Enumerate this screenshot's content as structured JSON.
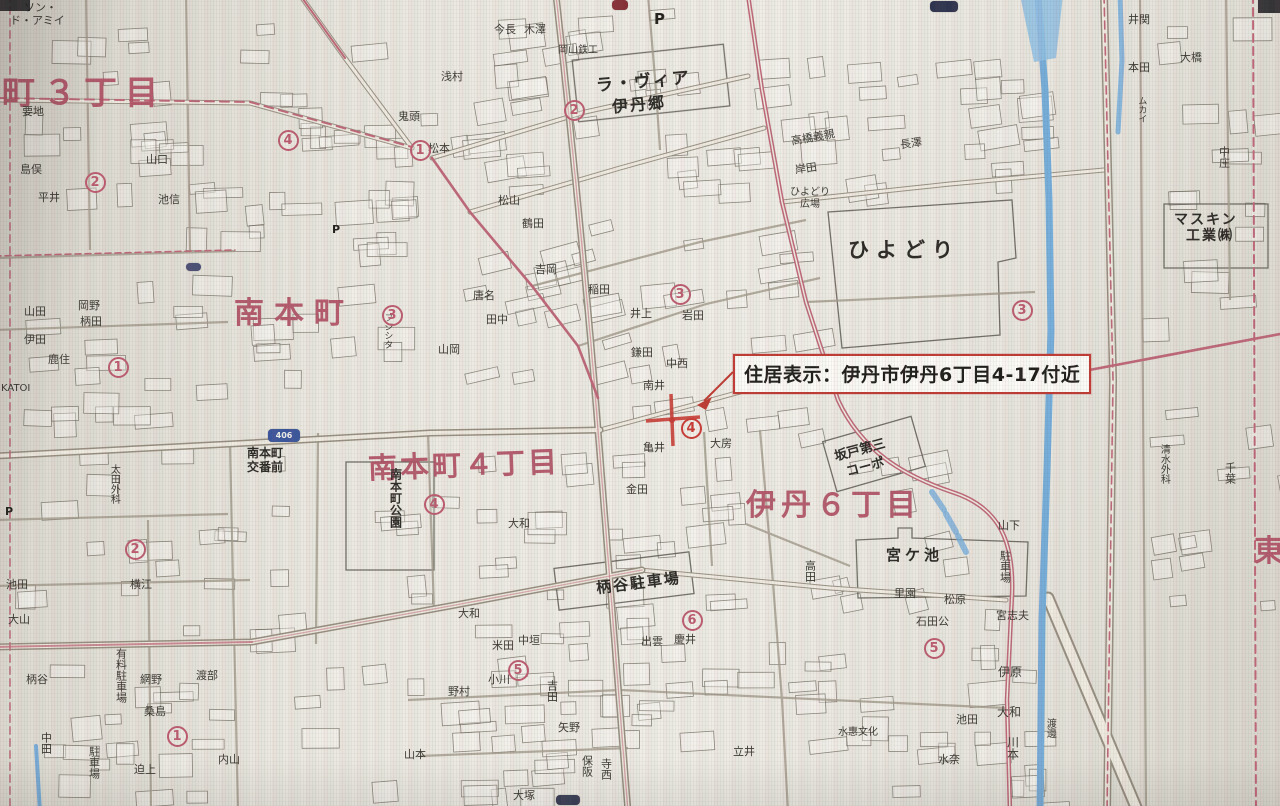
{
  "annotation": {
    "label": "住居表示：伊丹市伊丹6丁目4-17付近"
  },
  "colors": {
    "district_pink": "#b44f64",
    "annotation_red": "#c43a32",
    "river_blue": "#74aedd",
    "road_pink": "#c2677a",
    "paper": "#e9e6de"
  },
  "marker": {
    "x": 672,
    "y": 420
  },
  "map": {
    "labels": [
      {
        "t": "町３丁目",
        "x": 2,
        "y": 76,
        "s": 33,
        "c": "pink",
        "ls": 8
      },
      {
        "t": "南本町",
        "x": 234,
        "y": 298,
        "s": 30,
        "c": "pink",
        "ls": 10
      },
      {
        "t": "南本町４丁目",
        "x": 368,
        "y": 450,
        "s": 29,
        "c": "pink",
        "ls": 3,
        "r": -2
      },
      {
        "t": "伊丹６丁目",
        "x": 746,
        "y": 490,
        "s": 30,
        "c": "pink",
        "ls": 5
      },
      {
        "t": "東",
        "x": 1254,
        "y": 536,
        "s": 30,
        "c": "pink"
      },
      {
        "t": "ラ・ヴィア",
        "x": 596,
        "y": 74,
        "s": 17,
        "c": "place",
        "r": -5,
        "ls": 2
      },
      {
        "t": "伊丹郷",
        "x": 612,
        "y": 97,
        "s": 16,
        "c": "place",
        "r": -5,
        "ls": 2
      },
      {
        "t": "ひよどり",
        "x": 848,
        "y": 240,
        "s": 21,
        "c": "place",
        "ls": 7
      },
      {
        "t": "ひよどり",
        "x": 790,
        "y": 188,
        "s": 10
      },
      {
        "t": "広場",
        "x": 800,
        "y": 200,
        "s": 10
      },
      {
        "t": "宮ケ池",
        "x": 886,
        "y": 548,
        "s": 15,
        "c": "place",
        "ls": 4
      },
      {
        "t": "柄谷駐車場",
        "x": 596,
        "y": 576,
        "s": 15,
        "c": "place",
        "r": -7,
        "ls": 2
      },
      {
        "t": "坂戸第三",
        "x": 834,
        "y": 444,
        "s": 13,
        "c": "place",
        "r": -15
      },
      {
        "t": "コーポ",
        "x": 846,
        "y": 461,
        "s": 13,
        "c": "place",
        "r": -15
      },
      {
        "t": "南本町",
        "x": 247,
        "y": 447,
        "s": 12,
        "c": "place"
      },
      {
        "t": "交番前",
        "x": 247,
        "y": 461,
        "s": 12,
        "c": "place"
      },
      {
        "t": "南本町公園",
        "x": 389,
        "y": 468,
        "s": 12,
        "c": "place",
        "v": 1
      },
      {
        "t": "マスキン",
        "x": 1174,
        "y": 213,
        "s": 14,
        "c": "place",
        "ls": 2
      },
      {
        "t": "工業㈱",
        "x": 1186,
        "y": 229,
        "s": 14,
        "c": "place",
        "ls": 2
      },
      {
        "t": "有料駐車場",
        "x": 115,
        "y": 648,
        "s": 11,
        "v": 1
      },
      {
        "t": "駐車場",
        "x": 88,
        "y": 746,
        "s": 11,
        "v": 1
      },
      {
        "t": "駐車場",
        "x": 999,
        "y": 550,
        "s": 11,
        "v": 1
      },
      {
        "t": "山下",
        "x": 998,
        "y": 520,
        "s": 11
      },
      {
        "t": "高橋義親",
        "x": 791,
        "y": 132,
        "s": 11,
        "r": -10
      },
      {
        "t": "岸田",
        "x": 795,
        "y": 163,
        "s": 11,
        "r": -8
      },
      {
        "t": "長澤",
        "x": 900,
        "y": 138,
        "s": 11,
        "r": -8
      },
      {
        "t": "ソン・",
        "x": 24,
        "y": 2,
        "s": 11
      },
      {
        "t": "ド・アミイ",
        "x": 10,
        "y": 15,
        "s": 11
      },
      {
        "t": "今長",
        "x": 494,
        "y": 24,
        "s": 11
      },
      {
        "t": "木澤",
        "x": 524,
        "y": 24,
        "s": 11
      },
      {
        "t": "岡山鉄工",
        "x": 558,
        "y": 46,
        "s": 10
      },
      {
        "t": "浅村",
        "x": 441,
        "y": 71,
        "s": 11
      },
      {
        "t": "鬼頭",
        "x": 398,
        "y": 111,
        "s": 11
      },
      {
        "t": "松本",
        "x": 428,
        "y": 143,
        "s": 11
      },
      {
        "t": "松山",
        "x": 498,
        "y": 195,
        "s": 11
      },
      {
        "t": "鶴田",
        "x": 522,
        "y": 218,
        "s": 11
      },
      {
        "t": "吉岡",
        "x": 535,
        "y": 264,
        "s": 11
      },
      {
        "t": "唐名",
        "x": 473,
        "y": 290,
        "s": 11
      },
      {
        "t": "田中",
        "x": 486,
        "y": 314,
        "s": 11
      },
      {
        "t": "山岡",
        "x": 438,
        "y": 344,
        "s": 11
      },
      {
        "t": "フジシタ",
        "x": 382,
        "y": 313,
        "s": 9,
        "v": 1
      },
      {
        "t": "稲田",
        "x": 588,
        "y": 284,
        "s": 11
      },
      {
        "t": "井上",
        "x": 630,
        "y": 308,
        "s": 11
      },
      {
        "t": "岩田",
        "x": 682,
        "y": 310,
        "s": 11
      },
      {
        "t": "鎌田",
        "x": 631,
        "y": 347,
        "s": 11
      },
      {
        "t": "中西",
        "x": 666,
        "y": 358,
        "s": 11
      },
      {
        "t": "南井",
        "x": 643,
        "y": 380,
        "s": 11
      },
      {
        "t": "亀井",
        "x": 643,
        "y": 442,
        "s": 11
      },
      {
        "t": "大房",
        "x": 710,
        "y": 438,
        "s": 11
      },
      {
        "t": "金田",
        "x": 626,
        "y": 484,
        "s": 11
      },
      {
        "t": "大和",
        "x": 508,
        "y": 518,
        "s": 11
      },
      {
        "t": "出雲",
        "x": 641,
        "y": 636,
        "s": 11
      },
      {
        "t": "慶井",
        "x": 674,
        "y": 634,
        "s": 11
      },
      {
        "t": "大和",
        "x": 458,
        "y": 608,
        "s": 11
      },
      {
        "t": "米田",
        "x": 492,
        "y": 640,
        "s": 11
      },
      {
        "t": "中垣",
        "x": 518,
        "y": 635,
        "s": 11
      },
      {
        "t": "野村",
        "x": 448,
        "y": 686,
        "s": 11
      },
      {
        "t": "小川",
        "x": 488,
        "y": 674,
        "s": 11
      },
      {
        "t": "矢野",
        "x": 558,
        "y": 722,
        "s": 11
      },
      {
        "t": "山本",
        "x": 404,
        "y": 749,
        "s": 11
      },
      {
        "t": "吉田",
        "x": 546,
        "y": 680,
        "s": 11,
        "v": 1
      },
      {
        "t": "保阪",
        "x": 581,
        "y": 755,
        "s": 11,
        "v": 1
      },
      {
        "t": "寺西",
        "x": 600,
        "y": 758,
        "s": 11,
        "v": 1
      },
      {
        "t": "大塚",
        "x": 513,
        "y": 790,
        "s": 11
      },
      {
        "t": "立井",
        "x": 733,
        "y": 746,
        "s": 11
      },
      {
        "t": "高田",
        "x": 804,
        "y": 560,
        "s": 11,
        "v": 1
      },
      {
        "t": "石田公",
        "x": 916,
        "y": 616,
        "s": 11
      },
      {
        "t": "里園",
        "x": 894,
        "y": 588,
        "s": 11
      },
      {
        "t": "松原",
        "x": 944,
        "y": 594,
        "s": 11
      },
      {
        "t": "宮志夫",
        "x": 996,
        "y": 610,
        "s": 11
      },
      {
        "t": "伊原",
        "x": 998,
        "y": 666,
        "s": 12
      },
      {
        "t": "大和",
        "x": 997,
        "y": 706,
        "s": 12
      },
      {
        "t": "川本",
        "x": 1006,
        "y": 736,
        "s": 12,
        "v": 1
      },
      {
        "t": "渡邊",
        "x": 1044,
        "y": 718,
        "s": 10,
        "v": 1
      },
      {
        "t": "池田",
        "x": 956,
        "y": 714,
        "s": 11
      },
      {
        "t": "水奈",
        "x": 938,
        "y": 754,
        "s": 11
      },
      {
        "t": "水惠文化",
        "x": 838,
        "y": 728,
        "s": 10
      },
      {
        "t": "井関",
        "x": 1128,
        "y": 14,
        "s": 11
      },
      {
        "t": "本田",
        "x": 1128,
        "y": 62,
        "s": 11
      },
      {
        "t": "ムカイ",
        "x": 1136,
        "y": 96,
        "s": 9,
        "v": 1
      },
      {
        "t": "大橋",
        "x": 1180,
        "y": 52,
        "s": 11
      },
      {
        "t": "中庄",
        "x": 1218,
        "y": 146,
        "s": 11,
        "v": 1
      },
      {
        "t": "清水外科",
        "x": 1158,
        "y": 444,
        "s": 10,
        "v": 1
      },
      {
        "t": "千葉",
        "x": 1224,
        "y": 462,
        "s": 11,
        "v": 1
      },
      {
        "t": "島俣",
        "x": 20,
        "y": 164,
        "s": 11
      },
      {
        "t": "要地",
        "x": 22,
        "y": 106,
        "s": 11
      },
      {
        "t": "平井",
        "x": 38,
        "y": 192,
        "s": 11
      },
      {
        "t": "池信",
        "x": 158,
        "y": 194,
        "s": 11
      },
      {
        "t": "山口",
        "x": 146,
        "y": 154,
        "s": 11
      },
      {
        "t": "山田",
        "x": 24,
        "y": 306,
        "s": 11
      },
      {
        "t": "岡野",
        "x": 78,
        "y": 300,
        "s": 11
      },
      {
        "t": "柄田",
        "x": 80,
        "y": 316,
        "s": 11
      },
      {
        "t": "伊田",
        "x": 24,
        "y": 334,
        "s": 11
      },
      {
        "t": "鹿住",
        "x": 48,
        "y": 354,
        "s": 11
      },
      {
        "t": "KATOI",
        "x": 1,
        "y": 384,
        "s": 10
      },
      {
        "t": "太田外科",
        "x": 108,
        "y": 464,
        "s": 10,
        "v": 1
      },
      {
        "t": "横江",
        "x": 130,
        "y": 579,
        "s": 11
      },
      {
        "t": "池田",
        "x": 6,
        "y": 579,
        "s": 11
      },
      {
        "t": "大山",
        "x": 8,
        "y": 614,
        "s": 11
      },
      {
        "t": "柄谷",
        "x": 26,
        "y": 674,
        "s": 11
      },
      {
        "t": "網野",
        "x": 140,
        "y": 674,
        "s": 11
      },
      {
        "t": "桑島",
        "x": 144,
        "y": 706,
        "s": 11
      },
      {
        "t": "渡部",
        "x": 196,
        "y": 670,
        "s": 11
      },
      {
        "t": "迫上",
        "x": 134,
        "y": 764,
        "s": 11
      },
      {
        "t": "内山",
        "x": 218,
        "y": 754,
        "s": 11
      },
      {
        "t": "中田",
        "x": 40,
        "y": 732,
        "s": 11,
        "v": 1
      },
      {
        "t": "P",
        "x": 654,
        "y": 12,
        "s": 15,
        "c": "pmark"
      },
      {
        "t": "P",
        "x": 332,
        "y": 224,
        "s": 11,
        "c": "pmark"
      },
      {
        "t": "P",
        "x": 5,
        "y": 506,
        "s": 11,
        "c": "pmark"
      }
    ],
    "circled_numbers": [
      {
        "n": "1",
        "x": 420,
        "y": 150
      },
      {
        "n": "4",
        "x": 288,
        "y": 140
      },
      {
        "n": "2",
        "x": 95,
        "y": 182
      },
      {
        "n": "1",
        "x": 118,
        "y": 367
      },
      {
        "n": "2",
        "x": 135,
        "y": 549
      },
      {
        "n": "2",
        "x": 574,
        "y": 110
      },
      {
        "n": "3",
        "x": 392,
        "y": 315
      },
      {
        "n": "3",
        "x": 680,
        "y": 294
      },
      {
        "n": "3",
        "x": 1022,
        "y": 310
      },
      {
        "n": "4",
        "x": 434,
        "y": 504
      },
      {
        "n": "4",
        "x": 691,
        "y": 428,
        "strong": 1
      },
      {
        "n": "5",
        "x": 518,
        "y": 670
      },
      {
        "n": "6",
        "x": 692,
        "y": 620
      },
      {
        "n": "5",
        "x": 934,
        "y": 648
      },
      {
        "n": "1",
        "x": 177,
        "y": 736
      }
    ],
    "badges": [
      {
        "t": "406",
        "x": 268,
        "y": 429,
        "w": 32,
        "h": 13,
        "bg": "#3a56a0",
        "fs": 8
      },
      {
        "t": "",
        "x": 556,
        "y": 795,
        "w": 24,
        "h": 10,
        "bg": "#3a3f58",
        "fs": 7
      },
      {
        "t": "",
        "x": 930,
        "y": 1,
        "w": 28,
        "h": 11,
        "bg": "#2e3450",
        "fs": 7
      },
      {
        "t": "",
        "x": 186,
        "y": 263,
        "w": 15,
        "h": 8,
        "bg": "#4a4f78",
        "fs": 7
      },
      {
        "t": "",
        "x": 612,
        "y": 0,
        "w": 16,
        "h": 10,
        "bg": "#8b2f38",
        "fs": 7
      }
    ]
  }
}
